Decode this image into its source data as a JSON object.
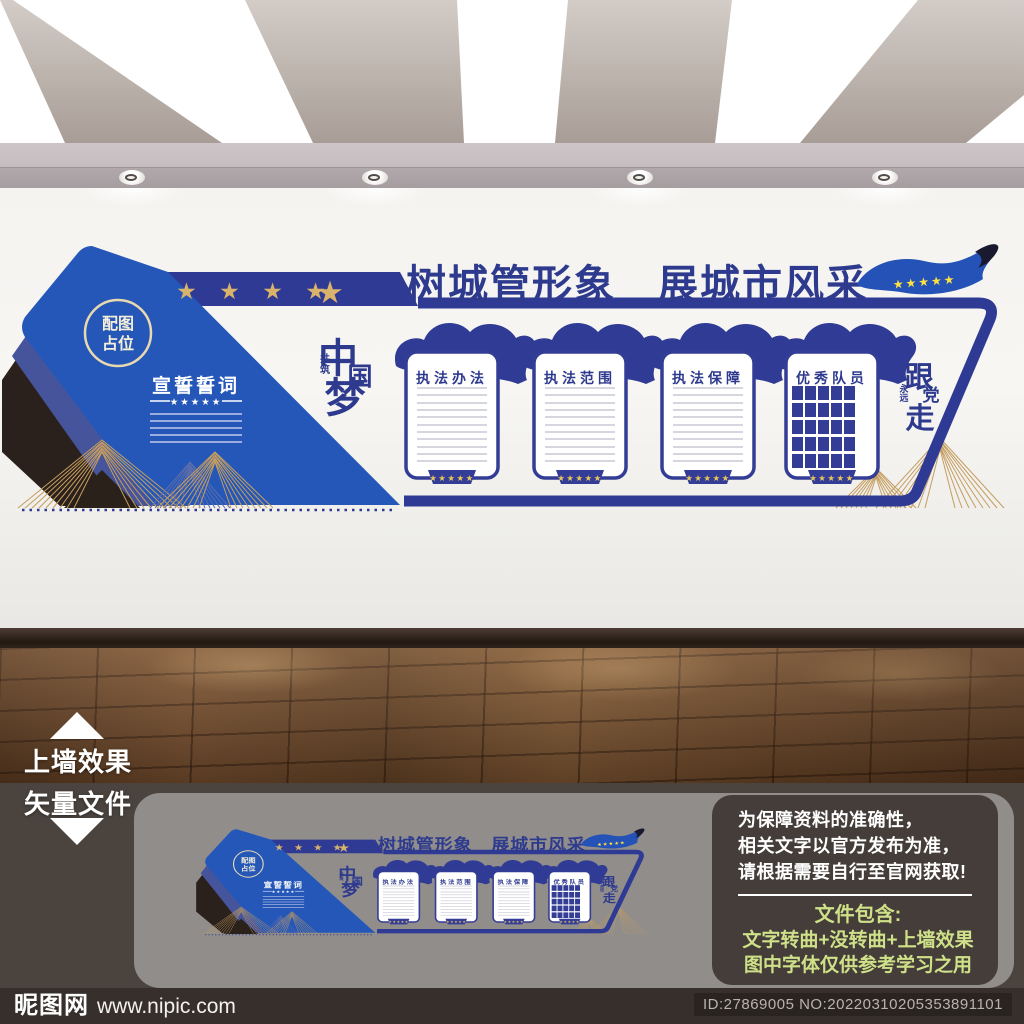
{
  "wall": {
    "band_stars": "★ ★ ★ ★",
    "band_star_big": "★",
    "title": "树城管形象　展城市风采",
    "flag_stars": "★★★★★",
    "placeholder": {
      "line1": "配图",
      "line2": "占位"
    },
    "oath": {
      "title": "宣誓誓词",
      "stars": "★★★★★"
    },
    "slogan_left": {
      "c1": "中",
      "c2": "国",
      "c3": "梦",
      "s1": "共",
      "s2": "筑"
    },
    "slogan_right": {
      "c1": "跟",
      "c2": "党",
      "c3": "走",
      "s1": "永",
      "s2": "远"
    },
    "panels": [
      {
        "title": "执法办法"
      },
      {
        "title": "执法范围"
      },
      {
        "title": "执法保障"
      },
      {
        "title": "优秀队员"
      }
    ],
    "tab_stars": "★★★★★"
  },
  "labels": {
    "wall_effect": "上墙效果",
    "vector_file": "矢量文件"
  },
  "notice": {
    "line1": "为保障资料的准确性，",
    "line2": "相关文字以官方发布为准，",
    "line3": "请根据需要自行至官网获取!",
    "package_title": "文件包含:",
    "package_line1": "文字转曲+没转曲+上墙效果",
    "package_line2": "图中字体仅供参考学习之用"
  },
  "footer": {
    "logo": "昵图网",
    "url": "www.nipic.com",
    "id_text": "ID:27869005 NO:20220310205353891101"
  },
  "colors": {
    "primary_blue": "#2457b8",
    "navy": "#2e3a93",
    "gold": "#c59d5f",
    "star_gold": "#d9b26b",
    "flag_star_yellow": "#ffe23e",
    "accent_green": "#cfe188"
  }
}
